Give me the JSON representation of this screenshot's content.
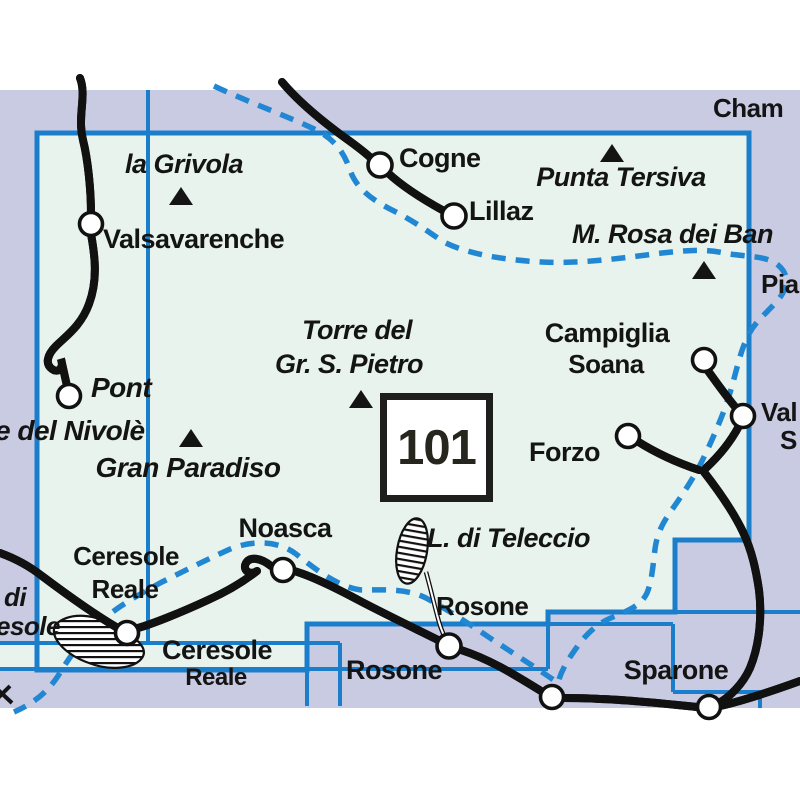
{
  "map": {
    "type": "map-sheet-index",
    "sheet_number": "101",
    "colors": {
      "background_outside": "#ffffff",
      "adjacent_area_lavender": "#c9cbe3",
      "highlighted_sheet_green": "#e7f3ec",
      "sheet_boundary_blue": "#1b7ecb",
      "park_boundary_dash_blue": "#2187d2",
      "label_color": "#141414",
      "road_casing": "#111111",
      "road_fill": "#ffffff"
    },
    "labels": {
      "cham": "Cham",
      "la_grivola": "la Grivola",
      "valsavarenche": "Valsavarenche",
      "cogne": "Cogne",
      "lillaz": "Lillaz",
      "punta_tersiva": "Punta Tersiva",
      "m_rosa_dei_banchi": "M. Rosa dei Ban",
      "pia": "Pia",
      "torre_line1": "Torre del",
      "torre_line2": "Gr. S. Pietro",
      "campiglia": "Campiglia",
      "soana": "Soana",
      "val_cut": "Val",
      "s_cut": "S",
      "forzo": "Forzo",
      "pont": "Pont",
      "nivole_cut": "e del Nivolè",
      "gran_paradiso": "Gran Paradiso",
      "sheet_number": "101",
      "noasca": "Noasca",
      "ceresole_1a": "Ceresole",
      "ceresole_1b": "Reale",
      "lago_teleccio": "L. di Teleccio",
      "di_cut": "di",
      "esole_cut": "esole",
      "rosone_1": "Rosone",
      "rosone_2": "Rosone",
      "sparone": "Sparone",
      "ceresole_2a": "Ceresole",
      "ceresole_2b": "Reale"
    },
    "symbols": {
      "peak_triangles": [
        "la Grivola",
        "Punta Tersiva",
        "M. Rosa dei Banchi",
        "Torre del Gr. S. Pietro",
        "Gran Paradiso"
      ],
      "town_circles": [
        "Valsavarenche",
        "Pont",
        "Cogne",
        "Lillaz",
        "Campiglia Soana",
        "Val junction",
        "Forzo",
        "Noasca",
        "Ceresole Reale",
        "Rosone",
        "bottom road junction",
        "bottom right junction"
      ],
      "lakes_hatched": [
        "L. di Teleccio",
        "L. di Ceresole"
      ]
    }
  }
}
